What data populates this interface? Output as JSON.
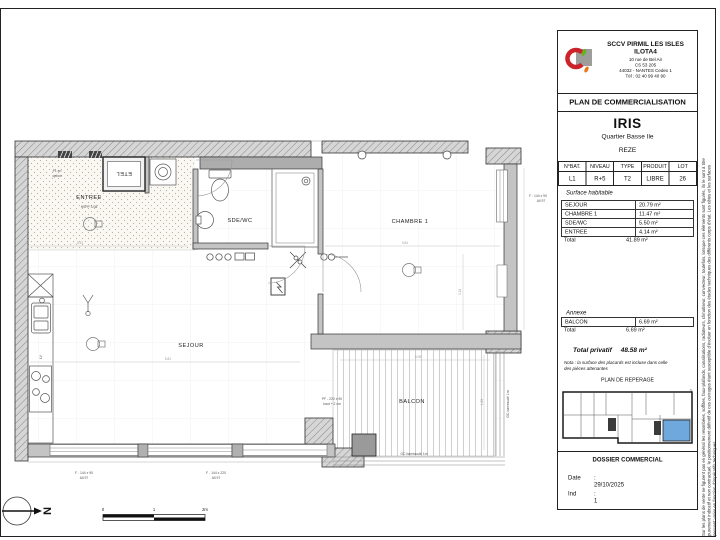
{
  "company": {
    "name1": "SCCV PIRMIL LES ISLES",
    "name2": "ILOTA4",
    "addr1": "10 rue de Bel Air",
    "addr2": "CS 53 205",
    "addr3": "44032 - NANTES Cedex 1",
    "addr4": "Tél : 02 40 99 40 90"
  },
  "doc_title": "PLAN DE COMMERCIALISATION",
  "project": {
    "name": "IRIS",
    "district": "Quartier Basse Ile",
    "city": "REZE"
  },
  "lot": {
    "h1": "N°BAT.",
    "h2": "NIVEAU",
    "h3": "TYPE",
    "h4": "PRODUIT",
    "h5": "LOT",
    "v1": "L1",
    "v2": "R+5",
    "v3": "T2",
    "v4": "LIBRE",
    "v5": "26"
  },
  "surfaces": {
    "title": "Surface habitable",
    "r1l": "SEJOUR",
    "r1v": "20.79 m²",
    "r2l": "CHAMBRE 1",
    "r2v": "11.47 m²",
    "r3l": "SDE/WC",
    "r3v": "5.50 m²",
    "r4l": "ENTREE",
    "r4v": "4.14 m²",
    "total_l": "Total",
    "total_v": "41.89 m²"
  },
  "annexe": {
    "title": "Annexe",
    "r1l": "BALCON",
    "r1v": "6.69 m²",
    "total_l": "Total",
    "total_v": "6.69 m²"
  },
  "privatif": {
    "label": "Total privatif",
    "value": "48.58 m²"
  },
  "nota1": "Nota : la surface des placards est incluse dans celle",
  "nota2": "des pièces attenantes",
  "reperage": "PLAN DE REPERAGE",
  "dossier": {
    "title": "DOSSIER COMMERCIAL",
    "date_l": "Date",
    "date_v": ": 29/10/2025",
    "ind_l": "Ind",
    "ind_v": ": 1"
  },
  "disclaimer1": "Sur les plans de vente ne figurent pas en général les retombées, soffites, faux-plafonds, canalisations, radiateurs, climatiseur, convecteur, toutefois, lorsque ces éléments sont figurés, ils le sont à titre",
  "disclaimer2": "purement indicatif et non contractuel, le positionnement définitif de ces ouvrages étant susceptible d'évoluer en fonction des études techniques des différents corps d'état. Les côtes et les surfaces",
  "disclaimer3": "peuvent varier en fonction d'impératifs techniques.",
  "plan": {
    "rooms": {
      "entree": "ENTREE",
      "sdewc": "SDE/WC",
      "chambre": "CHAMBRE 1",
      "sejour": "SEJOUR",
      "balcon": "BALCON"
    },
    "ann": {
      "hsfp": "HSFP 3.08",
      "pl1": "PL en",
      "pl2": "option",
      "etel": "ETEL",
      "pf1": "PF - 220 x 90",
      "pf2": "haut + 2 cm",
      "gc_b": "GC barreaudé 1m",
      "gc_r": "GC barreaudé 1m",
      "fr1": "F : 144 x 90",
      "fr2": "All 97",
      "fb1a": "F - 144 x 90",
      "fb1b": "All 97",
      "fb2a": "F - 144 x 220",
      "fb2b": "All 97",
      "lv": "LV"
    },
    "dims": {
      "d1": "3.37",
      "d2": "5.81",
      "d3": "3.81",
      "d4": "3.18",
      "d5": "3.05",
      "d6": "1.85"
    },
    "scale": {
      "s0": "0",
      "s1": "1",
      "s2": "2m"
    },
    "north": "N"
  },
  "colors": {
    "unit_highlight": "#6fa8dc",
    "wall_gray": "#c4c4c4",
    "logo_red": "#cc2229",
    "logo_green": "#6ab023",
    "logo_orange": "#e87511",
    "logo_gray": "#9d9d9c"
  }
}
